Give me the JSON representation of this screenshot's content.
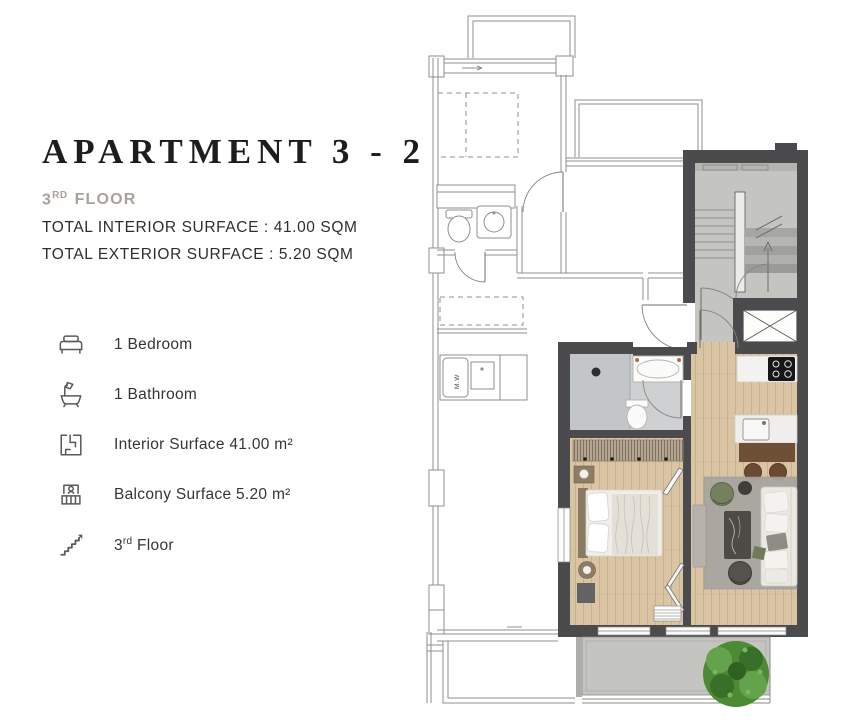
{
  "page": {
    "background": "#ffffff"
  },
  "header": {
    "title": "APARTMENT 3 - 2",
    "floor": {
      "number": "3",
      "suffix": "RD",
      "word": "FLOOR"
    },
    "interior_line": "TOTAL INTERIOR SURFACE : 41.00 SQM",
    "exterior_line": "TOTAL EXTERIOR SURFACE : 5.20 SQM"
  },
  "features": [
    {
      "icon": "bed-icon",
      "label": "1 Bedroom"
    },
    {
      "icon": "bathtub-icon",
      "label": "1 Bathroom"
    },
    {
      "icon": "floorplan-icon",
      "label": "Interior Surface 41.00 m²"
    },
    {
      "icon": "balcony-icon",
      "label": "Balcony Surface 5.20 m²"
    },
    {
      "icon": "stairs-icon",
      "label_number": "3",
      "label_suffix": "rd",
      "label_rest": " Floor"
    }
  ],
  "floor_plan": {
    "washer_label": "M.W",
    "rooms": [
      "bedroom",
      "bathroom",
      "living-kitchen",
      "hallway",
      "balcony",
      "stairwell",
      "elevator",
      "neighbor-unit-outline"
    ]
  },
  "colors": {
    "title_text": "#1d1d1f",
    "muted_text": "#a9a29b",
    "body_text": "#2e2e2e",
    "icon_stroke": "#595a5e",
    "wall": "#4b4b4d",
    "outline": "#8f8f8f",
    "wood": "#d9c4a4",
    "wood_line": "#c4ab88",
    "tile": "#ced0d1",
    "tile_dark": "#c3c6c8",
    "concrete": "#c4c4c0",
    "rug": "#a8a5a0",
    "island_wood": "#6e4f37",
    "stool": "#6b4a33",
    "sofa": "#eae8e3",
    "headboard": "#8a7a64",
    "wardrobe": "#b3a58f",
    "green_chair": "#76805f",
    "dark_chair": "#55514c",
    "tree": "#4c8a36",
    "tree_dark": "#38702a",
    "tree_light": "#64a24b"
  }
}
